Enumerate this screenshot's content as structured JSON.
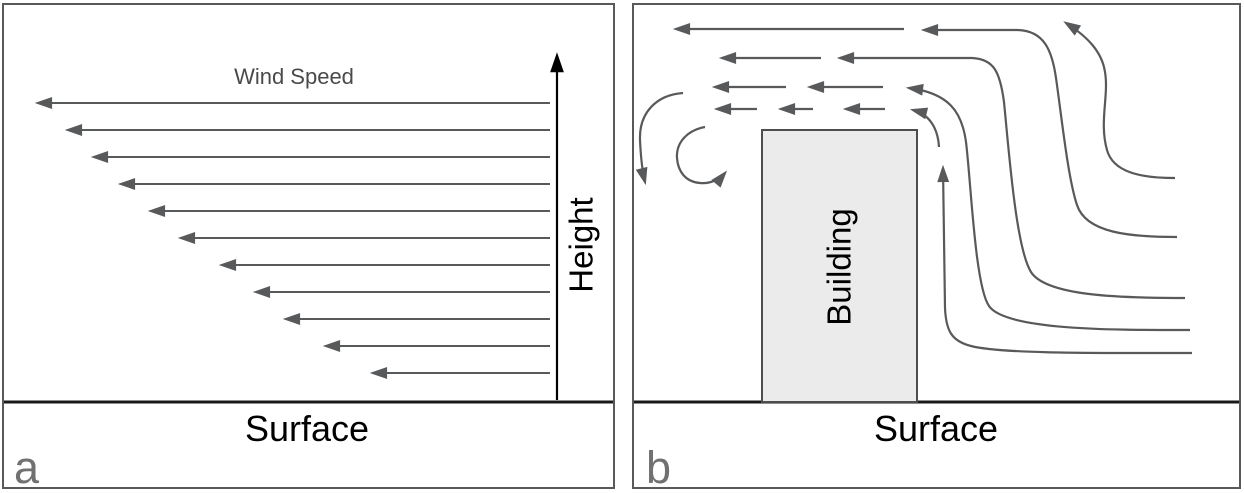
{
  "figure": {
    "colors": {
      "line": "#58595b",
      "axis": "#000000",
      "surface_line": "#1a1a1a",
      "panel_border": "#58595b",
      "building_fill": "#ebebeb",
      "building_stroke": "#4d4d4d",
      "label_gray": "#717171",
      "text_gray": "#4a4a4a"
    },
    "panel_a": {
      "letter": "a",
      "wind_speed_label": "Wind Speed",
      "height_label": "Height",
      "surface_label": "Surface",
      "wind_profile": {
        "tail_x": 550,
        "axis_x": 557,
        "surface_y": 402,
        "arrows": [
          {
            "y": 103,
            "tip": 32
          },
          {
            "y": 130,
            "tip": 62
          },
          {
            "y": 157,
            "tip": 88
          },
          {
            "y": 184,
            "tip": 115
          },
          {
            "y": 211,
            "tip": 145
          },
          {
            "y": 238,
            "tip": 175
          },
          {
            "y": 265,
            "tip": 216
          },
          {
            "y": 292,
            "tip": 250
          },
          {
            "y": 319,
            "tip": 280
          },
          {
            "y": 346,
            "tip": 320
          },
          {
            "y": 373,
            "tip": 367
          }
        ]
      }
    },
    "panel_b": {
      "letter": "b",
      "building_label": "Building",
      "surface_label": "Surface",
      "building": {
        "x": 762,
        "y": 130,
        "w": 155,
        "h": 272
      },
      "surface_y": 402,
      "short_arrows": [
        {
          "x1": 904,
          "x2": 676,
          "y": 29
        },
        {
          "x1": 821,
          "x2": 722,
          "y": 58
        },
        {
          "x1": 786,
          "x2": 715,
          "y": 87
        },
        {
          "x1": 883,
          "x2": 810,
          "y": 87
        },
        {
          "x1": 757,
          "x2": 717,
          "y": 109
        },
        {
          "x1": 813,
          "x2": 781,
          "y": 109
        },
        {
          "x1": 885,
          "x2": 846,
          "y": 109
        }
      ],
      "streamlines": [
        "M1175,178 C1140,178 1113,172 1107,150 C1099,122 1109,96 1105,72 C1102,52 1088,37 1066,23",
        "M1177,237 C1130,237 1086,233 1077,205 C1068,178 1062,120 1056,78 C1052,50 1044,31 1018,30 L924,30",
        "M1185,298 C1120,298 1046,296 1031,272 C1016,248 1009,152 1004,102 C1000,72 994,59 972,58 L840,58",
        "M1190,330 C1120,330 1006,331 989,306 C975,286 971,182 966,142 C962,112 949,93 909,88",
        "M1192,353 C1100,353 1002,354 971,346 C951,341 946,330 945,308 L943,168",
        "M939,147 C938,128 929,114 913,110"
      ],
      "eddies": [
        "M683,93 C656,95 639,113 640,140 C641,162 643,174 645,182",
        "M705,127 C688,130 676,142 677,158 C678,172 686,182 700,183 C711,184 720,179 725,173"
      ]
    }
  }
}
